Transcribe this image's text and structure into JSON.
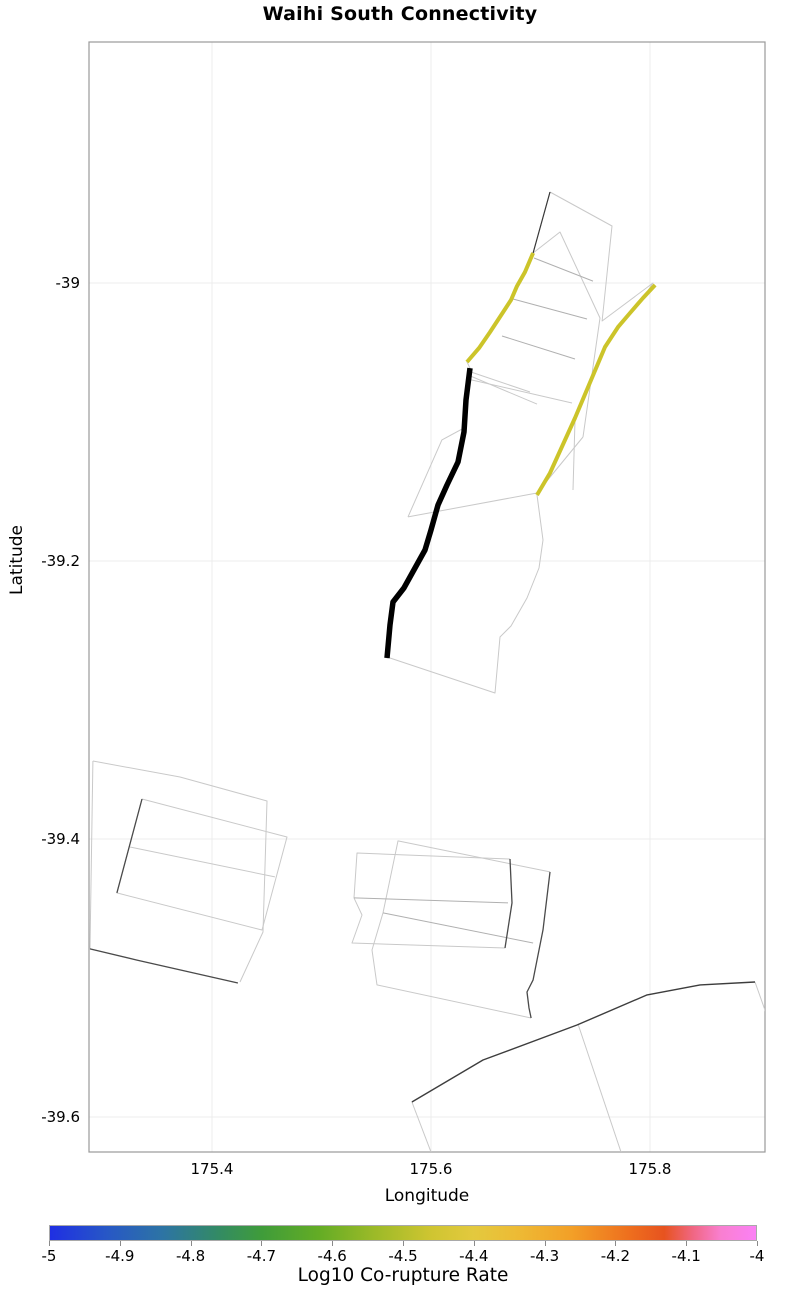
{
  "title": "Waihi South Connectivity",
  "styles": {
    "background": "#ffffff",
    "grid_color": "#ececec",
    "border_color": "#9a9a9a",
    "light_line": "#c9c9c9",
    "mid_line": "#b0b0b0",
    "dark_line": "#4a4a4a",
    "black_line": "#000000",
    "yellow_line": "#ccc42a"
  },
  "chart_data": {
    "type": "line",
    "title": "Waihi South Connectivity",
    "xlabel": "Longitude",
    "ylabel": "Latitude",
    "xlim": [
      175.2877,
      175.905
    ],
    "ylim": [
      -39.6252,
      -38.8266
    ],
    "grid": true,
    "x_ticks": [
      {
        "value": 175.4,
        "label": "175.4"
      },
      {
        "value": 175.6,
        "label": "175.6"
      },
      {
        "value": 175.8,
        "label": "175.8"
      }
    ],
    "y_ticks": [
      {
        "value": -39.0,
        "label": "-39"
      },
      {
        "value": -39.2,
        "label": "-39.2"
      },
      {
        "value": -39.4,
        "label": "-39.4"
      },
      {
        "value": -39.6,
        "label": "-39.6"
      }
    ],
    "series": [
      {
        "name": "upper-network-outline",
        "role": "fault-patch-outline",
        "color": "#c9c9c9",
        "width": 1,
        "points": [
          [
            175.7087,
            -38.9345
          ],
          [
            175.7653,
            -38.959
          ],
          [
            175.7562,
            -39.0273
          ],
          [
            175.8027,
            -39.0
          ],
          [
            175.7936,
            -39.0108
          ],
          [
            175.7817,
            -39.0216
          ],
          [
            175.7708,
            -39.0317
          ],
          [
            175.7589,
            -39.046
          ],
          [
            175.7315,
            -39.0971
          ],
          [
            175.7087,
            -39.1367
          ],
          [
            175.6968,
            -39.1525
          ],
          [
            175.7023,
            -39.1849
          ],
          [
            175.6986,
            -39.205
          ],
          [
            175.6877,
            -39.2266
          ],
          [
            175.6731,
            -39.2468
          ],
          [
            175.663,
            -39.2547
          ],
          [
            175.6584,
            -39.295
          ],
          [
            175.5626,
            -39.2698
          ],
          [
            175.5598,
            -39.2698
          ],
          [
            175.5626,
            -39.246
          ],
          [
            175.5653,
            -39.2295
          ],
          [
            175.5753,
            -39.2194
          ],
          [
            175.5854,
            -39.205
          ],
          [
            175.5945,
            -39.1921
          ],
          [
            175.6,
            -39.1777
          ],
          [
            175.6064,
            -39.1597
          ],
          [
            175.6146,
            -39.1453
          ],
          [
            175.6247,
            -39.1288
          ],
          [
            175.6301,
            -39.1072
          ],
          [
            175.632,
            -39.0842
          ],
          [
            175.6356,
            -39.0612
          ],
          [
            175.6329,
            -39.0568
          ],
          [
            175.6438,
            -39.0468
          ],
          [
            175.6539,
            -39.0353
          ],
          [
            175.6658,
            -39.0209
          ],
          [
            175.6731,
            -39.0122
          ],
          [
            175.6785,
            -39.0022
          ],
          [
            175.6858,
            -38.9921
          ],
          [
            175.6932,
            -38.9784
          ],
          [
            175.7087,
            -38.9345
          ]
        ]
      },
      {
        "name": "upper-inner-edge",
        "role": "fault-patch-outline",
        "color": "#c9c9c9",
        "width": 1,
        "points": [
          [
            175.6932,
            -38.9784
          ],
          [
            175.7178,
            -38.9633
          ],
          [
            175.7543,
            -39.0252
          ],
          [
            175.7388,
            -39.1108
          ]
        ]
      },
      {
        "name": "upper-fan-1",
        "role": "fault-patch-outline",
        "color": "#c9c9c9",
        "width": 1,
        "points": [
          [
            175.6338,
            -39.0633
          ],
          [
            175.6904,
            -39.0784
          ]
        ]
      },
      {
        "name": "upper-fan-2",
        "role": "fault-patch-outline",
        "color": "#c9c9c9",
        "width": 1,
        "points": [
          [
            175.6338,
            -39.0662
          ],
          [
            175.6968,
            -39.0871
          ]
        ]
      },
      {
        "name": "upper-fan-3",
        "role": "fault-patch-outline",
        "color": "#c9c9c9",
        "width": 1,
        "points": [
          [
            175.6338,
            -39.0691
          ],
          [
            175.7288,
            -39.0863
          ]
        ]
      },
      {
        "name": "upper-cross-d",
        "role": "fault-patch-outline",
        "color": "#c9c9c9",
        "width": 1,
        "points": [
          [
            175.579,
            -39.1683
          ],
          [
            175.6968,
            -39.1511
          ]
        ]
      },
      {
        "name": "upper-patch-left-edge",
        "role": "fault-patch-outline",
        "color": "#c9c9c9",
        "width": 1,
        "points": [
          [
            175.6301,
            -39.1043
          ],
          [
            175.61,
            -39.1129
          ],
          [
            175.579,
            -39.1683
          ]
        ]
      },
      {
        "name": "upper-inner-link",
        "role": "fault-patch-outline",
        "color": "#c9c9c9",
        "width": 1,
        "points": [
          [
            175.7388,
            -39.1108
          ],
          [
            175.6968,
            -39.1511
          ]
        ]
      },
      {
        "name": "upper-inner-vertical",
        "role": "fault-patch-outline",
        "color": "#c9c9c9",
        "width": 1,
        "points": [
          [
            175.7315,
            -39.0986
          ],
          [
            175.7297,
            -39.1489
          ]
        ]
      },
      {
        "name": "upper-cross-a",
        "role": "fault-patch-outline",
        "color": "#b0b0b0",
        "width": 1,
        "points": [
          [
            175.6941,
            -38.982
          ],
          [
            175.7479,
            -38.9986
          ]
        ]
      },
      {
        "name": "upper-cross-b",
        "role": "fault-patch-outline",
        "color": "#b0b0b0",
        "width": 1,
        "points": [
          [
            175.6749,
            -39.0115
          ],
          [
            175.7425,
            -39.0259
          ]
        ]
      },
      {
        "name": "upper-cross-c",
        "role": "fault-patch-outline",
        "color": "#b0b0b0",
        "width": 1,
        "points": [
          [
            175.6648,
            -39.0381
          ],
          [
            175.7315,
            -39.0547
          ]
        ]
      },
      {
        "name": "lowerleft-quad-a",
        "role": "fault-patch-outline",
        "color": "#c9c9c9",
        "width": 1,
        "points": [
          [
            175.2913,
            -39.3439
          ],
          [
            175.3708,
            -39.3554
          ],
          [
            175.4502,
            -39.3727
          ],
          [
            175.4466,
            -39.4669
          ],
          [
            175.4256,
            -39.5029
          ]
        ]
      },
      {
        "name": "lowerleft-quad-a-left",
        "role": "fault-patch-outline",
        "color": "#c9c9c9",
        "width": 1,
        "points": [
          [
            175.2913,
            -39.3439
          ],
          [
            175.2886,
            -39.4791
          ]
        ]
      },
      {
        "name": "lowerleft-quad-b",
        "role": "fault-patch-outline",
        "color": "#c9c9c9",
        "width": 1,
        "points": [
          [
            175.3361,
            -39.3712
          ],
          [
            175.4685,
            -39.3986
          ],
          [
            175.4457,
            -39.4655
          ],
          [
            175.3132,
            -39.4388
          ],
          [
            175.3361,
            -39.3712
          ]
        ]
      },
      {
        "name": "lowerleft-mid-line",
        "role": "fault-patch-outline",
        "color": "#c9c9c9",
        "width": 1,
        "points": [
          [
            175.3251,
            -39.4058
          ],
          [
            175.4575,
            -39.4273
          ]
        ]
      },
      {
        "name": "lowerleft-trace",
        "role": "fault-trace",
        "color": "#4a4a4a",
        "width": 1.3,
        "points": [
          [
            175.2886,
            -39.4791
          ],
          [
            175.3315,
            -39.4871
          ],
          [
            175.4237,
            -39.5036
          ]
        ]
      },
      {
        "name": "lowerleft-quad-b-trace",
        "role": "fault-trace",
        "color": "#4a4a4a",
        "width": 1.3,
        "points": [
          [
            175.3361,
            -39.3712
          ],
          [
            175.3132,
            -39.4388
          ]
        ]
      },
      {
        "name": "lowermid-quad-1",
        "role": "fault-patch-outline",
        "color": "#c9c9c9",
        "width": 1,
        "points": [
          [
            175.6721,
            -39.4144
          ],
          [
            175.5324,
            -39.4101
          ],
          [
            175.5297,
            -39.4424
          ],
          [
            175.537,
            -39.4547
          ],
          [
            175.5279,
            -39.4748
          ],
          [
            175.6676,
            -39.4784
          ]
        ]
      },
      {
        "name": "lowermid-quad-2",
        "role": "fault-patch-outline",
        "color": "#c9c9c9",
        "width": 1,
        "points": [
          [
            175.7087,
            -39.4237
          ],
          [
            175.5699,
            -39.4014
          ],
          [
            175.5562,
            -39.4532
          ],
          [
            175.5461,
            -39.4799
          ],
          [
            175.5507,
            -39.505
          ],
          [
            175.6914,
            -39.5288
          ]
        ]
      },
      {
        "name": "lowermid-mid-1",
        "role": "fault-patch-outline",
        "color": "#b0b0b0",
        "width": 1,
        "points": [
          [
            175.5297,
            -39.4424
          ],
          [
            175.6703,
            -39.446
          ]
        ]
      },
      {
        "name": "lowermid-mid-2",
        "role": "fault-patch-outline",
        "color": "#b0b0b0",
        "width": 1,
        "points": [
          [
            175.5562,
            -39.4532
          ],
          [
            175.6932,
            -39.4748
          ]
        ]
      },
      {
        "name": "lowermid-quad-1-trace",
        "role": "fault-trace",
        "color": "#4a4a4a",
        "width": 1.3,
        "points": [
          [
            175.6721,
            -39.4144
          ],
          [
            175.674,
            -39.446
          ],
          [
            175.6676,
            -39.4784
          ]
        ]
      },
      {
        "name": "lowermid-quad-2-trace",
        "role": "fault-trace",
        "color": "#4a4a4a",
        "width": 1.3,
        "points": [
          [
            175.7087,
            -39.4237
          ],
          [
            175.7023,
            -39.4654
          ],
          [
            175.6932,
            -39.5014
          ],
          [
            175.6877,
            -39.5101
          ],
          [
            175.6895,
            -39.5216
          ],
          [
            175.6914,
            -39.5288
          ]
        ]
      },
      {
        "name": "bottomright-edge-right",
        "role": "fault-patch-outline",
        "color": "#c9c9c9",
        "width": 1,
        "points": [
          [
            175.8959,
            -39.5029
          ],
          [
            175.9059,
            -39.5252
          ]
        ]
      },
      {
        "name": "bottomright-edge-mid",
        "role": "fault-patch-outline",
        "color": "#c9c9c9",
        "width": 1,
        "points": [
          [
            175.7342,
            -39.5331
          ],
          [
            175.7735,
            -39.6252
          ]
        ]
      },
      {
        "name": "bottomright-edge-left",
        "role": "fault-patch-outline",
        "color": "#c9c9c9",
        "width": 1,
        "points": [
          [
            175.5826,
            -39.5892
          ],
          [
            175.6,
            -39.6252
          ]
        ]
      },
      {
        "name": "bottomright-trace",
        "role": "fault-trace",
        "color": "#3d3d3d",
        "width": 1.4,
        "points": [
          [
            175.5826,
            -39.5892
          ],
          [
            175.6475,
            -39.559
          ],
          [
            175.7333,
            -39.5338
          ],
          [
            175.7973,
            -39.5122
          ],
          [
            175.8457,
            -39.505
          ],
          [
            175.8959,
            -39.5029
          ]
        ]
      },
      {
        "name": "upper-top-dark-segment",
        "role": "fault-trace",
        "color": "#383838",
        "width": 1.2,
        "points": [
          [
            175.7087,
            -38.9345
          ],
          [
            175.6932,
            -38.9784
          ]
        ]
      },
      {
        "name": "connected-fault-west",
        "role": "co-rupture-fault",
        "color": "#ccc42a",
        "width": 4,
        "points": [
          [
            175.6932,
            -38.9784
          ],
          [
            175.6858,
            -38.9921
          ],
          [
            175.6785,
            -39.0022
          ],
          [
            175.6731,
            -39.0122
          ],
          [
            175.6658,
            -39.0209
          ],
          [
            175.6539,
            -39.0353
          ],
          [
            175.6438,
            -39.0468
          ],
          [
            175.6329,
            -39.0568
          ]
        ]
      },
      {
        "name": "connected-fault-east",
        "role": "co-rupture-fault",
        "color": "#ccc42a",
        "width": 4,
        "points": [
          [
            175.8046,
            -39.0014
          ],
          [
            175.7936,
            -39.0108
          ],
          [
            175.7817,
            -39.0216
          ],
          [
            175.7708,
            -39.0317
          ],
          [
            175.7589,
            -39.046
          ],
          [
            175.7315,
            -39.0971
          ],
          [
            175.7087,
            -39.1367
          ],
          [
            175.6968,
            -39.1525
          ]
        ]
      },
      {
        "name": "waihi-south-fault",
        "role": "target-fault",
        "color": "#000000",
        "width": 5.5,
        "points": [
          [
            175.6356,
            -39.0612
          ],
          [
            175.632,
            -39.0842
          ],
          [
            175.6301,
            -39.1072
          ],
          [
            175.6247,
            -39.1288
          ],
          [
            175.6146,
            -39.1453
          ],
          [
            175.6064,
            -39.1597
          ],
          [
            175.6,
            -39.1777
          ],
          [
            175.5945,
            -39.1921
          ],
          [
            175.5854,
            -39.205
          ],
          [
            175.5753,
            -39.2194
          ],
          [
            175.5653,
            -39.2295
          ],
          [
            175.5626,
            -39.246
          ],
          [
            175.5598,
            -39.2698
          ]
        ]
      }
    ],
    "colorbar": {
      "label": "Log10 Co-rupture Rate",
      "min": -5,
      "max": -4,
      "ticks": [
        {
          "value": -5.0,
          "label": "-5"
        },
        {
          "value": -4.9,
          "label": "-4.9"
        },
        {
          "value": -4.8,
          "label": "-4.8"
        },
        {
          "value": -4.7,
          "label": "-4.7"
        },
        {
          "value": -4.6,
          "label": "-4.6"
        },
        {
          "value": -4.5,
          "label": "-4.5"
        },
        {
          "value": -4.4,
          "label": "-4.4"
        },
        {
          "value": -4.3,
          "label": "-4.3"
        },
        {
          "value": -4.2,
          "label": "-4.2"
        },
        {
          "value": -4.1,
          "label": "-4.1"
        },
        {
          "value": -4.0,
          "label": "-4"
        }
      ],
      "gradient_stops": [
        {
          "pos": 0,
          "color": "#1f2fe3"
        },
        {
          "pos": 8,
          "color": "#2757c6"
        },
        {
          "pos": 16,
          "color": "#2d74a4"
        },
        {
          "pos": 24,
          "color": "#338b63"
        },
        {
          "pos": 30,
          "color": "#3f9c3a"
        },
        {
          "pos": 38,
          "color": "#63ac25"
        },
        {
          "pos": 46,
          "color": "#9cba28"
        },
        {
          "pos": 54,
          "color": "#cfc531"
        },
        {
          "pos": 60,
          "color": "#e3c93e"
        },
        {
          "pos": 66,
          "color": "#edbb35"
        },
        {
          "pos": 74,
          "color": "#f39f27"
        },
        {
          "pos": 82,
          "color": "#ee6f1e"
        },
        {
          "pos": 87,
          "color": "#e7531f"
        },
        {
          "pos": 91,
          "color": "#f06681"
        },
        {
          "pos": 95,
          "color": "#f97fd0"
        },
        {
          "pos": 100,
          "color": "#fb81f5"
        }
      ]
    }
  }
}
